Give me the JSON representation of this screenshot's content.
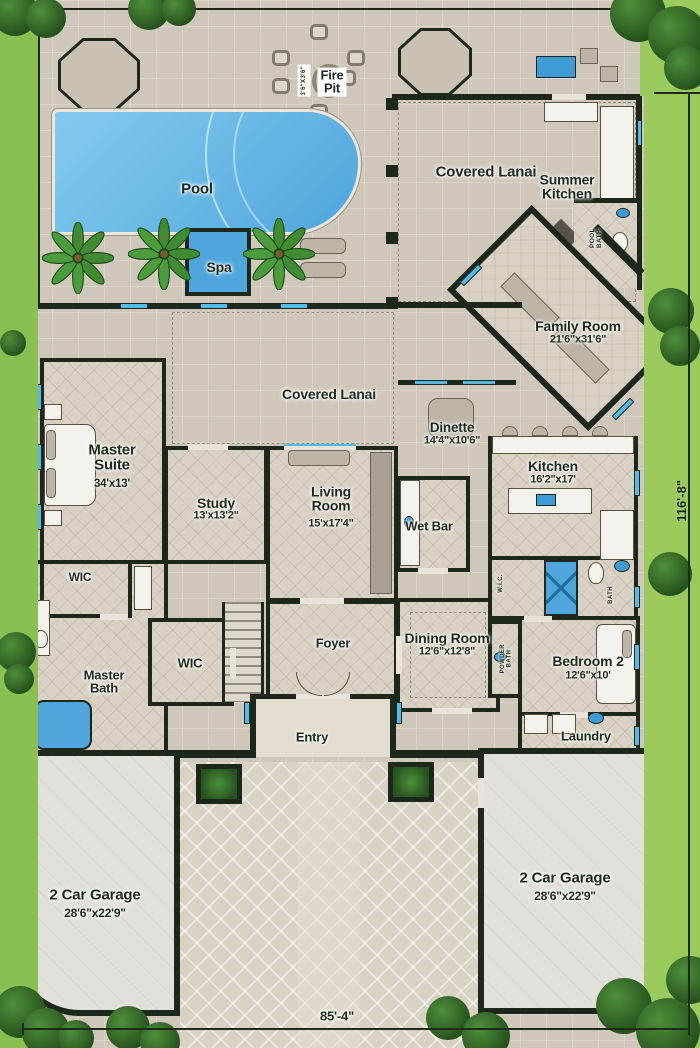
{
  "plan": {
    "site_width": "85'-4\"",
    "site_depth": "116'-8\"",
    "labels": {
      "pool": "Pool",
      "spa": "Spa",
      "fire_pit": "Fire\nPit",
      "fire_pit_dim": "3'6\"x3'6\"",
      "covered_lanai_top": "Covered Lanai",
      "summer_kitchen": "Summer\nKitchen",
      "pool_bath": "Pool\nBath",
      "family_room": "Family Room",
      "family_room_dim": "21'6\"x31'6\"",
      "covered_lanai_mid": "Covered Lanai",
      "dinette": "Dinette",
      "dinette_dim": "14'4\"x10'6\"",
      "master_suite": "Master\nSuite",
      "master_suite_dim": "34'x13'",
      "study": "Study",
      "study_dim": "13'x13'2\"",
      "living_room": "Living\nRoom",
      "living_room_dim": "15'x17'4\"",
      "wet_bar": "Wet Bar",
      "kitchen": "Kitchen",
      "kitchen_dim": "16'2\"x17'",
      "master_wic": "WIC",
      "master_bath": "Master\nBath",
      "hall_wic": "WIC",
      "foyer": "Foyer",
      "dining_room": "Dining Room",
      "dining_room_dim": "12'6\"x12'8\"",
      "bedroom2": "Bedroom 2",
      "bedroom2_dim": "12'6\"x10'",
      "bed2_wic": "W.I.C.",
      "bed2_bath": "Bath",
      "powder_bath": "Powder\nBath",
      "entry": "Entry",
      "laundry": "Laundry",
      "garage_left": "2 Car Garage",
      "garage_left_dim": "28'6\"x22'9\"",
      "garage_right": "2 Car Garage",
      "garage_right_dim": "28'6\"x22'9\""
    },
    "colors": {
      "wall": "#1b281b",
      "water": "#55aede",
      "window_accent": "#52bbea",
      "grass": "#8abf52",
      "paver": "#cfc8ba"
    }
  }
}
